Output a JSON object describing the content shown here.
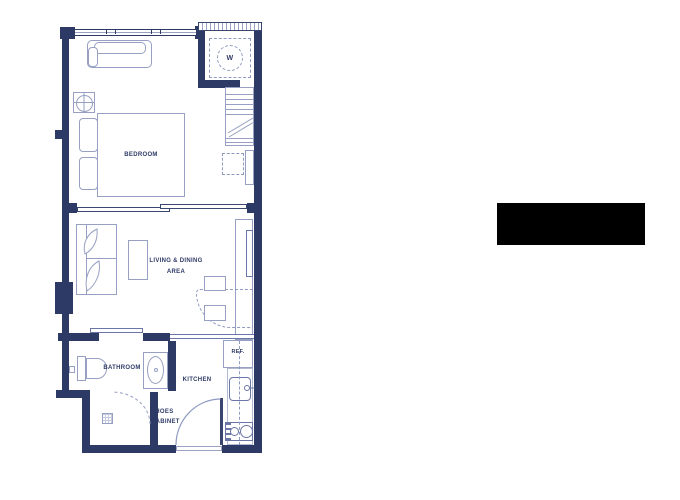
{
  "labels": {
    "bedroom": "BEDROOM",
    "living_area_line1": "LIVING & DINING",
    "living_area_line2": "AREA",
    "bathroom": "BATHROOM",
    "kitchen": "KITCHEN",
    "shoes_cabinet_line1": "SHOES",
    "shoes_cabinet_line2": "CABINET",
    "refrigerator": "REF.",
    "washer": "W"
  },
  "colors": {
    "wall_navy": "#2e3a66",
    "furniture_line": "#97a0c2",
    "accent_line": "#6b76a8",
    "label_text": "#2e3a66",
    "redaction_box": "#000000"
  }
}
